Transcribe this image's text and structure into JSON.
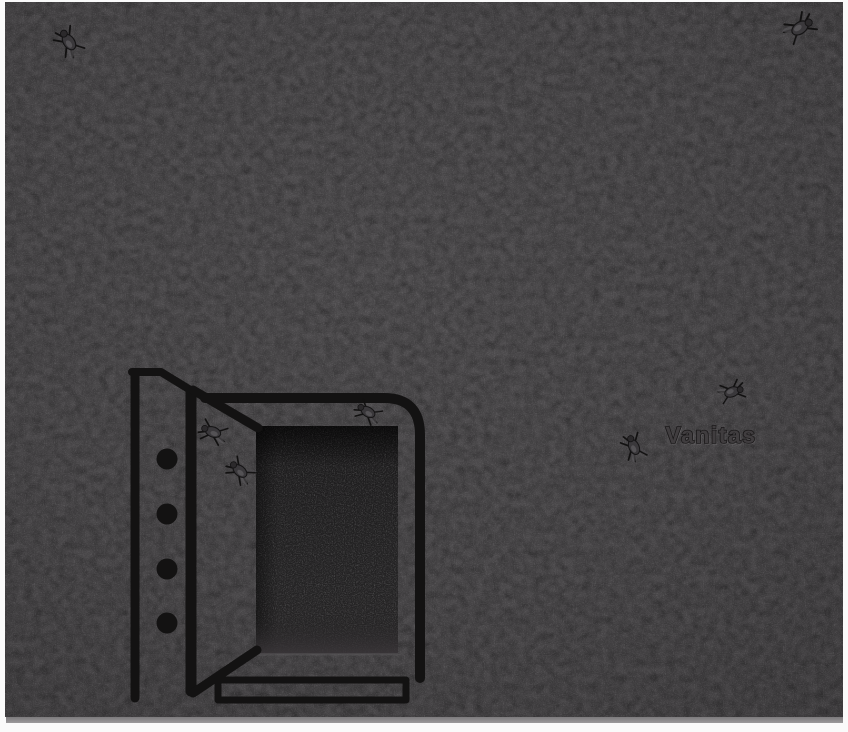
{
  "artwork": {
    "inscription": "Vanitas",
    "colors": {
      "mat": "#fafafa",
      "panel_center": "#4e4c4e",
      "panel_mid": "#494749",
      "panel_edge": "#403e40",
      "panel_side_light": "#807e80",
      "line": "#131212",
      "niche_top": "#1a191a",
      "niche_mid": "#232223",
      "niche_floor": "#343134",
      "fly_body": "#3a383b",
      "fly_highlight": "#5b595d",
      "fly_leg": "#121111",
      "inscription_fill": "#403d3f",
      "inscription_stroke": "#1a1819"
    },
    "flies": [
      {
        "name": "fly-top-left",
        "x": 69,
        "y": 42,
        "rot": -125,
        "s": 1.15
      },
      {
        "name": "fly-top-right",
        "x": 800,
        "y": 28,
        "rot": -35,
        "s": 1.2
      },
      {
        "name": "fly-on-safe-edge",
        "x": 368,
        "y": 412,
        "rot": -150,
        "s": 1.0
      },
      {
        "name": "fly-on-door-upper",
        "x": 213,
        "y": 432,
        "rot": -160,
        "s": 1.05
      },
      {
        "name": "fly-on-door-lower",
        "x": 240,
        "y": 471,
        "rot": -140,
        "s": 1.05
      },
      {
        "name": "fly-near-word",
        "x": 634,
        "y": 447,
        "rot": -115,
        "s": 1.05
      },
      {
        "name": "fly-above-word",
        "x": 732,
        "y": 392,
        "rot": -20,
        "s": 1.0
      }
    ]
  }
}
